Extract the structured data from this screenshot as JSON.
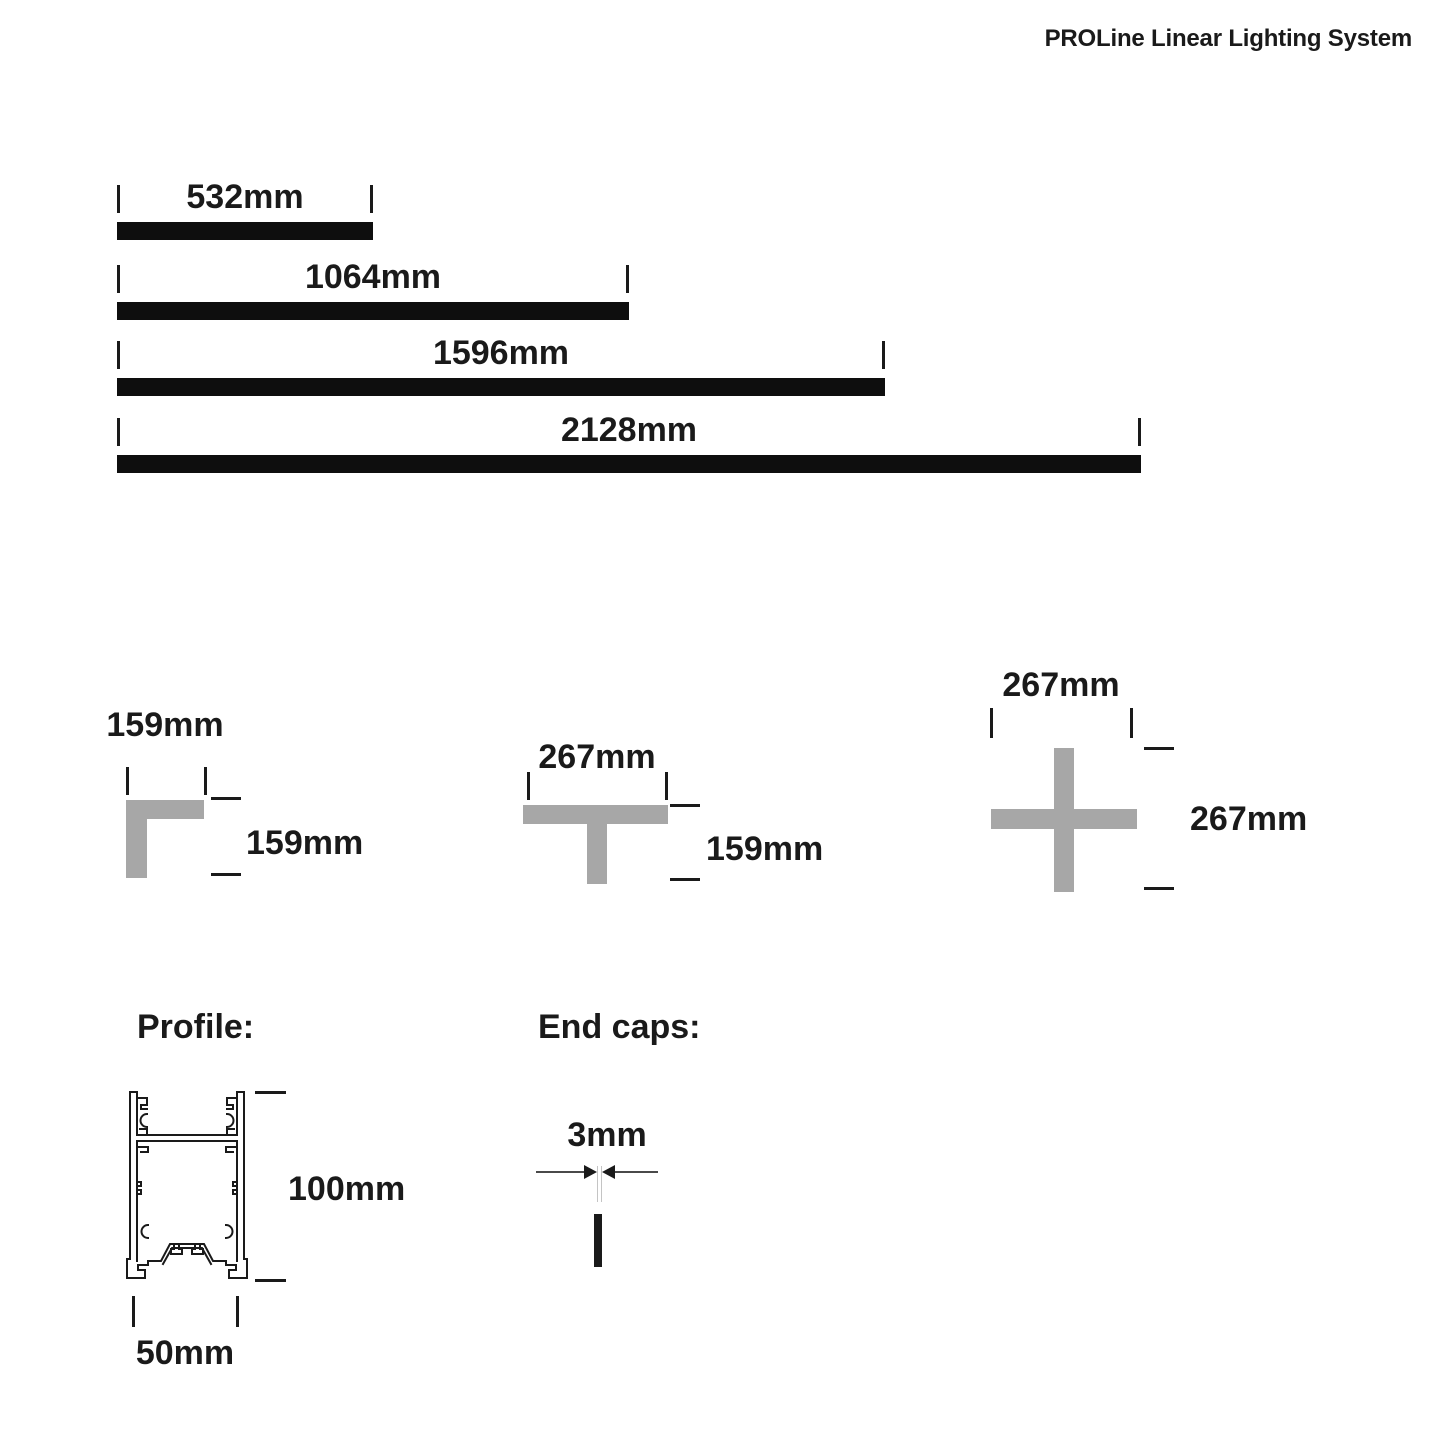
{
  "header": {
    "title": "PROLine Linear Lighting System"
  },
  "profiles": {
    "items": [
      {
        "name": "profile-532",
        "length_label": "532mm"
      },
      {
        "name": "profile-1064",
        "length_label": "1064mm"
      },
      {
        "name": "profile-1596",
        "length_label": "1596mm"
      },
      {
        "name": "profile-2128",
        "length_label": "2128mm"
      }
    ]
  },
  "connectors": {
    "l_connector": {
      "top_label": "159mm",
      "side_label": "159mm"
    },
    "t_connector": {
      "top_label": "267mm",
      "side_label": "159mm"
    },
    "x_connector": {
      "top_label": "267mm",
      "side_label": "267mm"
    }
  },
  "profile_section": {
    "heading": "Profile:",
    "height_label": "100mm",
    "width_label": "50mm"
  },
  "end_caps_section": {
    "heading": "End caps:",
    "gap_label": "3mm"
  },
  "colors": {
    "ink": "#1a1a1a",
    "bar_black": "#0e0e0e",
    "connector_gray": "#a7a7a7"
  }
}
